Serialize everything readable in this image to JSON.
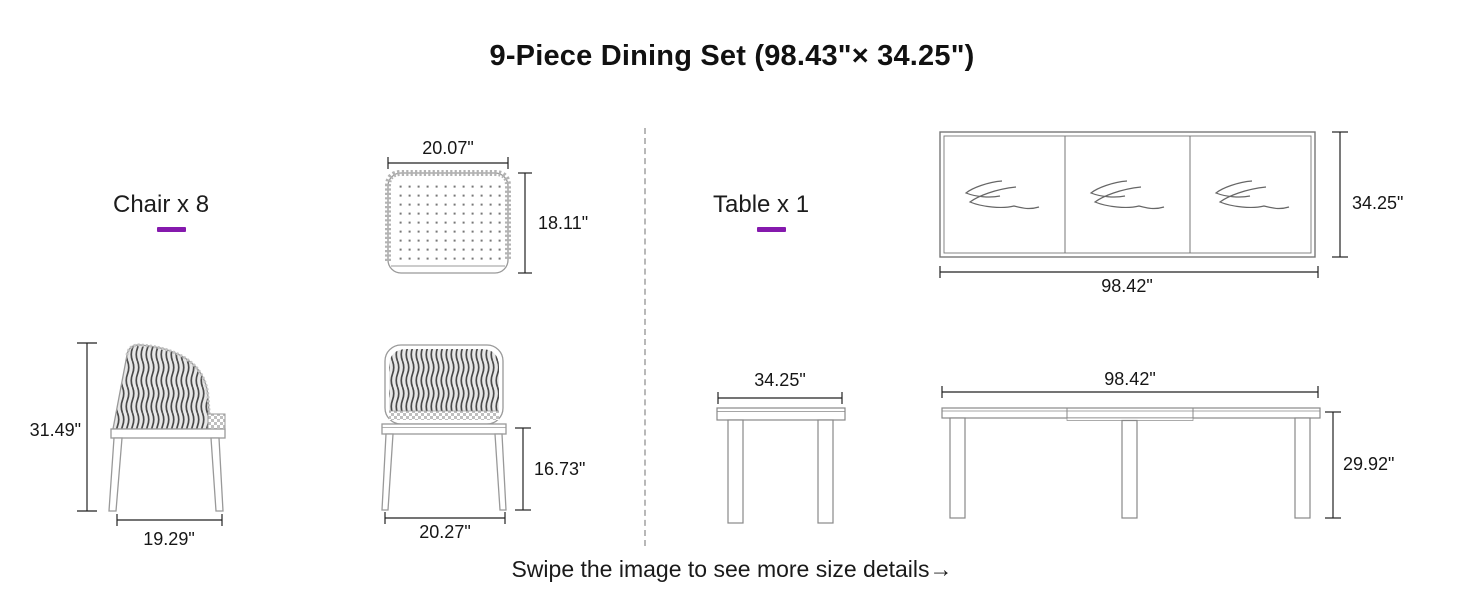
{
  "title": "9-Piece Dining Set (98.43\"× 34.25\")",
  "footer": "Swipe the image to see more size details→",
  "colors": {
    "accent": "#8519ad",
    "line": "#999999",
    "dim_line": "#222222"
  },
  "chair": {
    "label": "Chair x 8",
    "top_view": {
      "width": "20.07\"",
      "height": "18.11\""
    },
    "side_view": {
      "height": "31.49\"",
      "depth": "19.29\""
    },
    "front_view": {
      "seat_height": "16.73\"",
      "width": "20.27\""
    }
  },
  "table": {
    "label": "Table x 1",
    "top_view": {
      "length": "98.42\"",
      "width": "34.25\""
    },
    "end_view": {
      "width": "34.25\""
    },
    "side_view": {
      "length": "98.42\"",
      "height": "29.92\""
    }
  }
}
